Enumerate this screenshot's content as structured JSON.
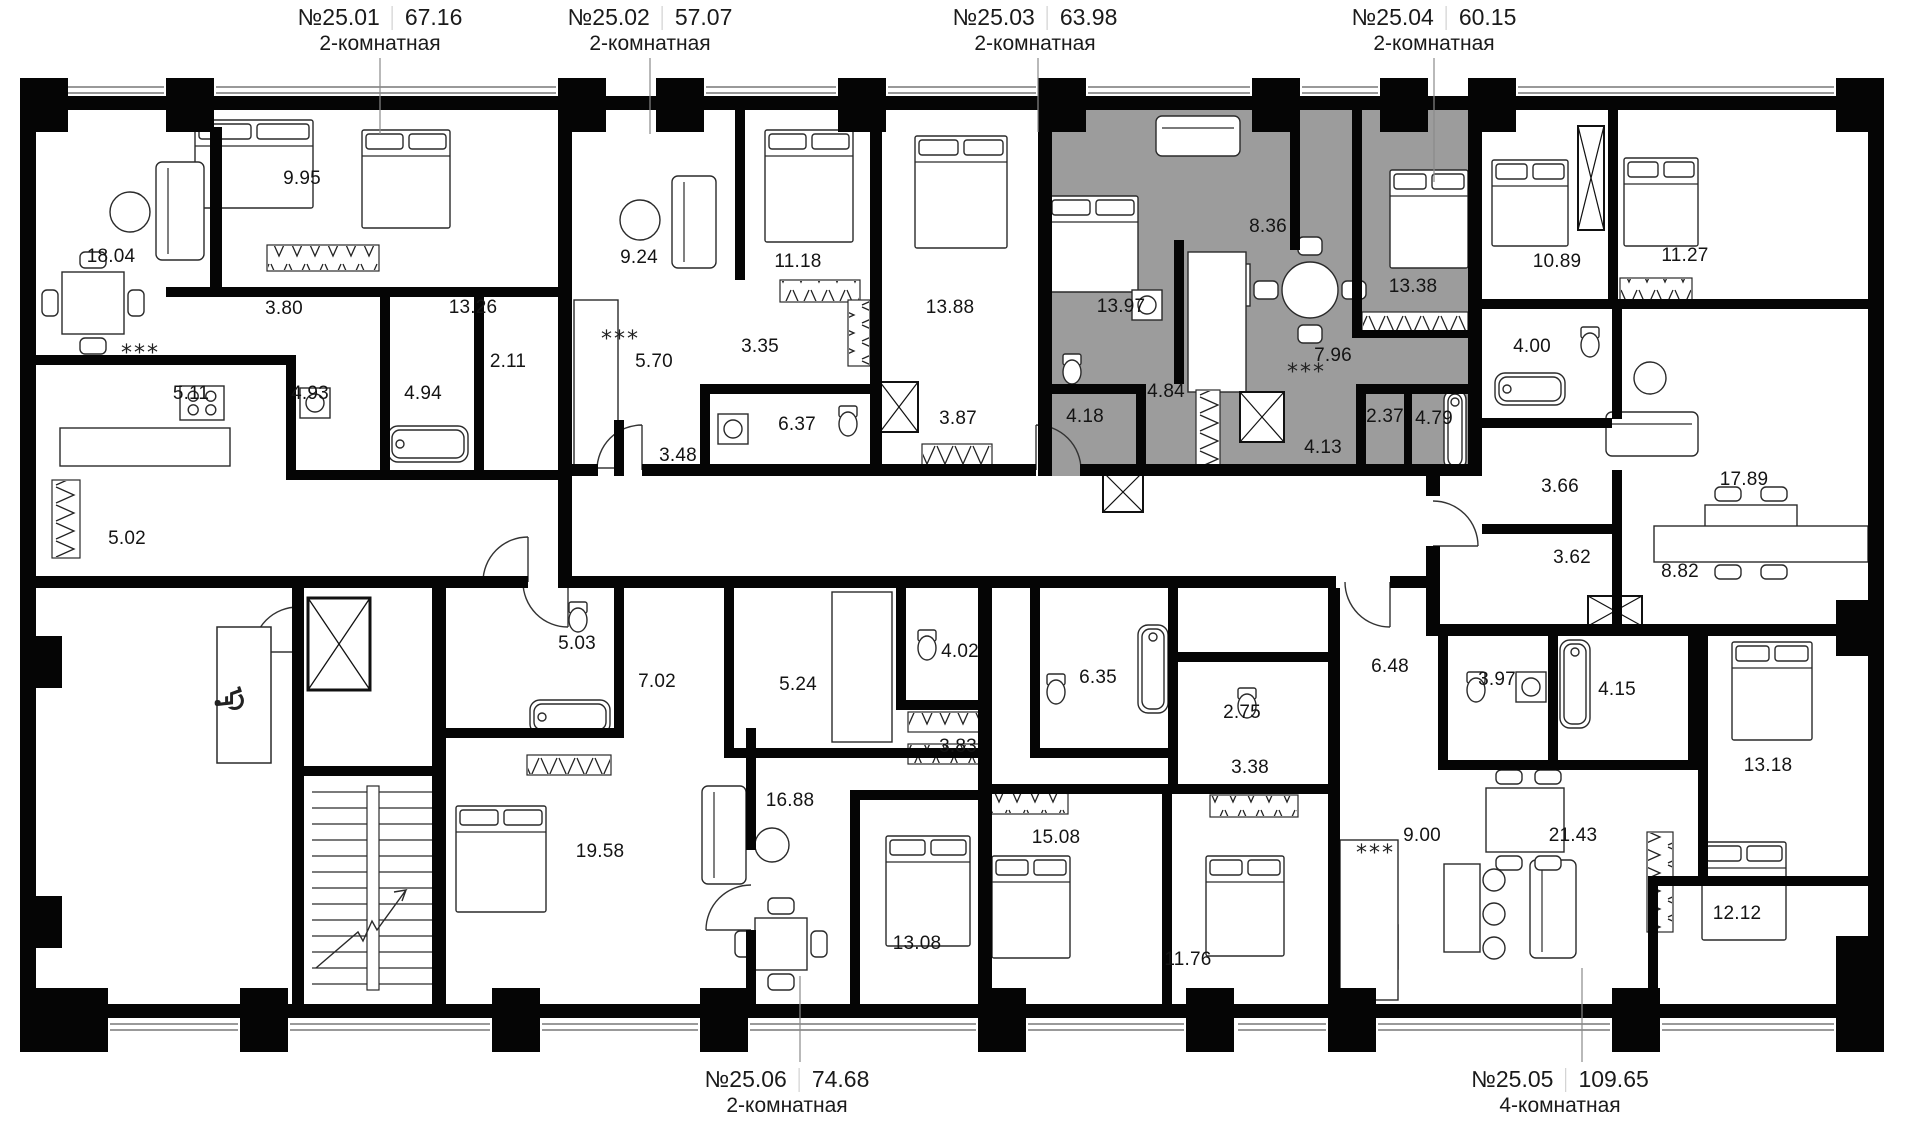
{
  "floor_plan": {
    "colors": {
      "background": "#ffffff",
      "wall": "#050505",
      "line": "#2a2a2a",
      "highlight_fill": "#9c9c9c",
      "text": "#1a1a1a",
      "divider": "#c9c9c9",
      "leader": "#8a8a8a"
    },
    "symbols": {
      "wheelchair": "♿",
      "washer": "***"
    },
    "apartments": [
      {
        "number": "№25.01",
        "area": "67.16",
        "type": "2-комнатная",
        "position": "top",
        "highlighted": false
      },
      {
        "number": "№25.02",
        "area": "57.07",
        "type": "2-комнатная",
        "position": "top",
        "highlighted": false
      },
      {
        "number": "№25.03",
        "area": "63.98",
        "type": "2-комнатная",
        "position": "top",
        "highlighted": true
      },
      {
        "number": "№25.04",
        "area": "60.15",
        "type": "2-комнатная",
        "position": "top",
        "highlighted": false
      },
      {
        "number": "№25.06",
        "area": "74.68",
        "type": "2-комнатная",
        "position": "bottom",
        "highlighted": false
      },
      {
        "number": "№25.05",
        "area": "109.65",
        "type": "4-комнатная",
        "position": "bottom",
        "highlighted": false
      }
    ],
    "apartment_label_anchors": [
      {
        "x": 380,
        "y": 4
      },
      {
        "x": 650,
        "y": 4
      },
      {
        "x": 1035,
        "y": 4
      },
      {
        "x": 1434,
        "y": 4
      },
      {
        "x": 787,
        "y": 1066
      },
      {
        "x": 1560,
        "y": 1066
      }
    ],
    "rooms": [
      {
        "apartment": "№25.01",
        "value": "18.04",
        "x": 111,
        "y": 257
      },
      {
        "apartment": "№25.01",
        "value": "9.95",
        "x": 302,
        "y": 179
      },
      {
        "apartment": "№25.01",
        "value": "3.80",
        "x": 284,
        "y": 309
      },
      {
        "apartment": "№25.01",
        "value": "13.26",
        "x": 473,
        "y": 308
      },
      {
        "apartment": "№25.01",
        "value": "5.11",
        "x": 191,
        "y": 394
      },
      {
        "apartment": "№25.01",
        "value": "4.93",
        "x": 310,
        "y": 394
      },
      {
        "apartment": "№25.01",
        "value": "4.94",
        "x": 423,
        "y": 394
      },
      {
        "apartment": "№25.01",
        "value": "2.11",
        "x": 508,
        "y": 362
      },
      {
        "apartment": "№25.01",
        "value": "5.02",
        "x": 127,
        "y": 539
      },
      {
        "apartment": "№25.02",
        "value": "9.24",
        "x": 639,
        "y": 258
      },
      {
        "apartment": "№25.02",
        "value": "11.18",
        "x": 798,
        "y": 262
      },
      {
        "apartment": "№25.02",
        "value": "13.88",
        "x": 950,
        "y": 308
      },
      {
        "apartment": "№25.02",
        "value": "5.70",
        "x": 654,
        "y": 362
      },
      {
        "apartment": "№25.02",
        "value": "3.35",
        "x": 760,
        "y": 347
      },
      {
        "apartment": "№25.02",
        "value": "6.37",
        "x": 797,
        "y": 425
      },
      {
        "apartment": "№25.02",
        "value": "3.48",
        "x": 678,
        "y": 456
      },
      {
        "apartment": "№25.02",
        "value": "3.87",
        "x": 958,
        "y": 419
      },
      {
        "apartment": "№25.03",
        "value": "13.97",
        "x": 1121,
        "y": 307
      },
      {
        "apartment": "№25.03",
        "value": "8.36",
        "x": 1268,
        "y": 227
      },
      {
        "apartment": "№25.03",
        "value": "13.38",
        "x": 1413,
        "y": 287
      },
      {
        "apartment": "№25.03",
        "value": "7.96",
        "x": 1333,
        "y": 356
      },
      {
        "apartment": "№25.03",
        "value": "4.18",
        "x": 1085,
        "y": 417
      },
      {
        "apartment": "№25.03",
        "value": "4.84",
        "x": 1166,
        "y": 392
      },
      {
        "apartment": "№25.03",
        "value": "4.13",
        "x": 1323,
        "y": 448
      },
      {
        "apartment": "№25.03",
        "value": "2.37",
        "x": 1385,
        "y": 417
      },
      {
        "apartment": "№25.03",
        "value": "4.79",
        "x": 1434,
        "y": 419
      },
      {
        "apartment": "№25.04",
        "value": "10.89",
        "x": 1557,
        "y": 262
      },
      {
        "apartment": "№25.04",
        "value": "11.27",
        "x": 1685,
        "y": 256
      },
      {
        "apartment": "№25.04",
        "value": "4.00",
        "x": 1532,
        "y": 347
      },
      {
        "apartment": "№25.04",
        "value": "3.66",
        "x": 1560,
        "y": 487
      },
      {
        "apartment": "№25.04",
        "value": "3.62",
        "x": 1572,
        "y": 558
      },
      {
        "apartment": "№25.04",
        "value": "8.82",
        "x": 1680,
        "y": 572
      },
      {
        "apartment": "№25.04",
        "value": "17.89",
        "x": 1744,
        "y": 480
      },
      {
        "apartment": "№25.06",
        "value": "5.03",
        "x": 577,
        "y": 644
      },
      {
        "apartment": "№25.06",
        "value": "7.02",
        "x": 657,
        "y": 682
      },
      {
        "apartment": "№25.06",
        "value": "5.24",
        "x": 798,
        "y": 685
      },
      {
        "apartment": "№25.06",
        "value": "4.02",
        "x": 960,
        "y": 652
      },
      {
        "apartment": "№25.06",
        "value": "3.83",
        "x": 958,
        "y": 747
      },
      {
        "apartment": "№25.06",
        "value": "16.88",
        "x": 790,
        "y": 801
      },
      {
        "apartment": "№25.06",
        "value": "19.58",
        "x": 600,
        "y": 852
      },
      {
        "apartment": "№25.06",
        "value": "13.08",
        "x": 917,
        "y": 944
      },
      {
        "apartment": "№25.05",
        "value": "6.35",
        "x": 1098,
        "y": 678
      },
      {
        "apartment": "№25.05",
        "value": "2.75",
        "x": 1242,
        "y": 713
      },
      {
        "apartment": "№25.05",
        "value": "3.38",
        "x": 1250,
        "y": 768
      },
      {
        "apartment": "№25.05",
        "value": "15.08",
        "x": 1056,
        "y": 838
      },
      {
        "apartment": "№25.05",
        "value": "11.76",
        "x": 1188,
        "y": 960
      },
      {
        "apartment": "№25.05",
        "value": "6.48",
        "x": 1390,
        "y": 667
      },
      {
        "apartment": "№25.05",
        "value": "3.97",
        "x": 1497,
        "y": 680
      },
      {
        "apartment": "№25.05",
        "value": "4.15",
        "x": 1617,
        "y": 690
      },
      {
        "apartment": "№25.05",
        "value": "13.18",
        "x": 1768,
        "y": 766
      },
      {
        "apartment": "№25.05",
        "value": "9.00",
        "x": 1422,
        "y": 836
      },
      {
        "apartment": "№25.05",
        "value": "21.43",
        "x": 1573,
        "y": 836
      },
      {
        "apartment": "№25.05",
        "value": "12.12",
        "x": 1737,
        "y": 914
      }
    ],
    "washer_symbol_positions": [
      {
        "x": 121,
        "y": 360
      },
      {
        "x": 601,
        "y": 346
      },
      {
        "x": 1287,
        "y": 379
      },
      {
        "x": 1356,
        "y": 860
      }
    ],
    "wheelchair_position": {
      "x": 244,
      "y": 698
    }
  }
}
